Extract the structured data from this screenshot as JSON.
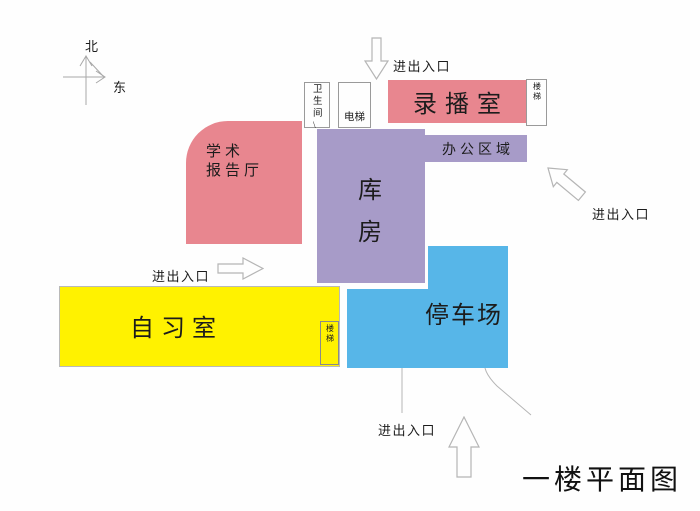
{
  "title": "一楼平面图",
  "compass": {
    "north_label": "北",
    "east_label": "东"
  },
  "entrances": {
    "top_label": "进出入口",
    "right_label": "进出入口",
    "left_label": "进出入口",
    "bottom_label": "进出入口"
  },
  "rooms": {
    "recording_room": {
      "label": "录播室",
      "color": "#e8868f"
    },
    "lecture_hall": {
      "line1": "学术",
      "line2": "报告厅",
      "color": "#e8868f"
    },
    "warehouse": {
      "label": "库房",
      "color": "#a79bc8"
    },
    "office_area": {
      "label": "办公区域",
      "color": "#a79bc8"
    },
    "study_room": {
      "label": "自习室",
      "color": "#fff200"
    },
    "parking_lot": {
      "label": "停车场",
      "color": "#57b6e8"
    },
    "restroom": {
      "label": "卫生间\\"
    },
    "elevator": {
      "label": "电梯"
    },
    "stairs_recording": {
      "label": "楼梯"
    },
    "stairs_study": {
      "label": "楼梯"
    }
  }
}
